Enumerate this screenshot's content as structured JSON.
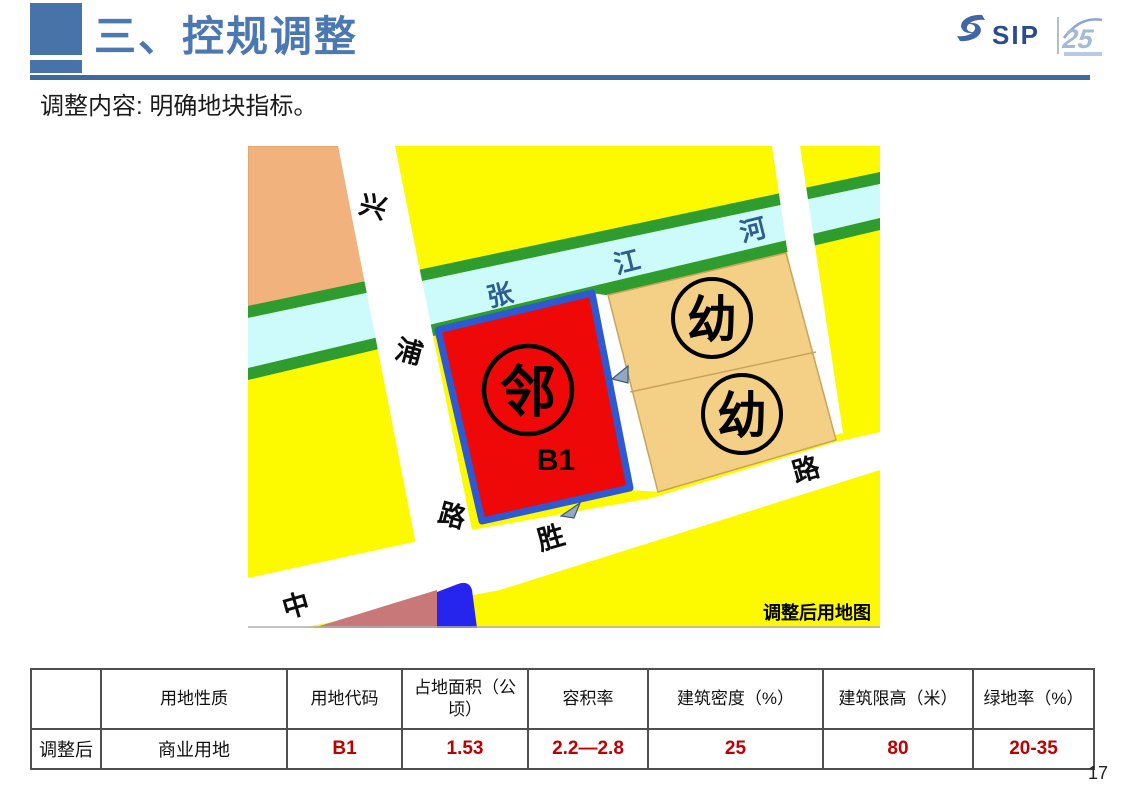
{
  "header": {
    "title": "三、控规调整",
    "subtitle": "调整内容: 明确地块指标。"
  },
  "logo": {
    "name": "SIP",
    "anniversary": "25"
  },
  "map": {
    "caption": "调整后用地图",
    "river_chars": [
      "张",
      "江",
      "河"
    ],
    "road_xingpu": [
      "兴",
      "浦",
      "路"
    ],
    "road_zhongsheng": [
      "中",
      "胜",
      "路"
    ],
    "block_neighborhood": "邻",
    "block_code": "B1",
    "block_kindergarten": "幼",
    "colors": {
      "land_yellow": "#fdfa00",
      "commercial_red": "#ef0808",
      "block_outline_blue": "#2d59d2",
      "kindergarten_tan": "#f4cf86",
      "river_cyan": "#cdfbfb",
      "green_buffer": "#2e9c2e",
      "peach_block": "#f2b27e",
      "maroon_block": "#c87878",
      "blue_block": "#2525ee"
    }
  },
  "table": {
    "headers": [
      "",
      "用地性质",
      "用地代码",
      "占地面积（公顷）",
      "容积率",
      "建筑密度（%）",
      "建筑限高（米）",
      "绿地率（%）"
    ],
    "row": [
      "调整后",
      "商业用地",
      "B1",
      "1.53",
      "2.2—2.8",
      "25",
      "80",
      "20-35"
    ]
  },
  "page_number": "17",
  "theme": {
    "accent_blue": "#4873a8",
    "value_red": "#c00000"
  }
}
